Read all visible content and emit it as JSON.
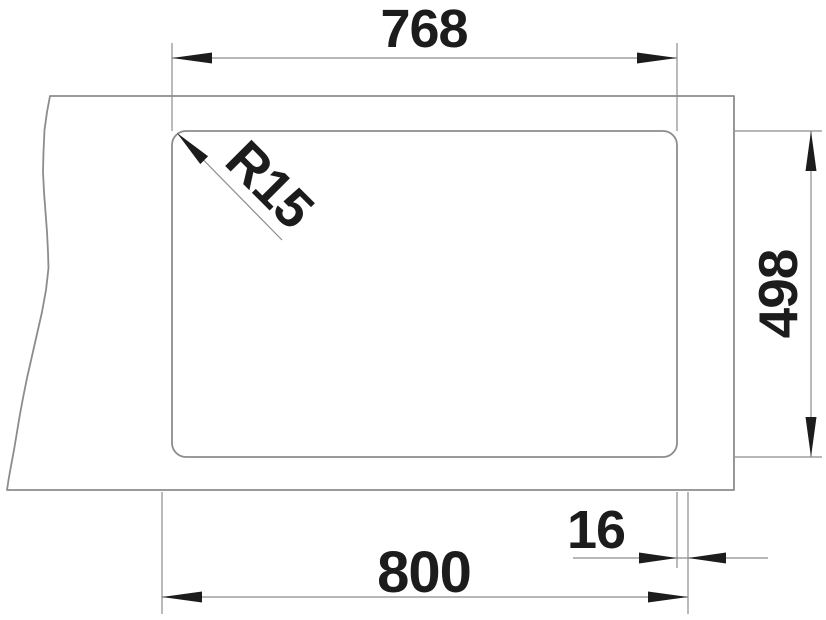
{
  "colors": {
    "background": "#ffffff",
    "line": "#8c8c8c",
    "ink": "#1c1c1c"
  },
  "drawing": {
    "type": "technical-dimension-drawing",
    "labels": {
      "inner_width": "768",
      "corner_radius": "R15",
      "depth": "498",
      "rim_offset": "16",
      "outer_width": "800"
    }
  }
}
